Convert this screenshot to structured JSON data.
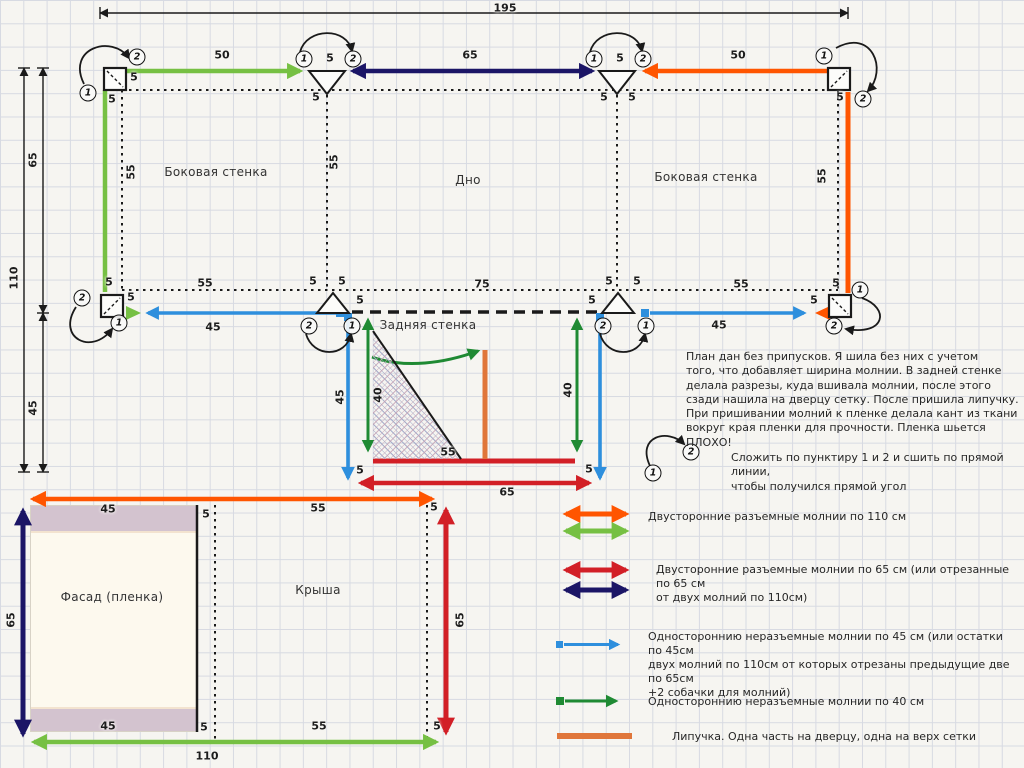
{
  "diagram_type": "sewing-pattern-plan",
  "colors": {
    "zipper_110_a": "#ff5500",
    "zipper_110_b": "#76c043",
    "zipper_65_a": "#d21f26",
    "zipper_65_b": "#1b1566",
    "zipper_45": "#2e8fdd",
    "zipper_40": "#1f8a33",
    "velcro": "#e0763a",
    "line": "#1a1a1a",
    "grid": "#d7dae2",
    "background": "#f6f5f1",
    "facade_band": "#d3c3cf",
    "facade_body": "#fdf9ee"
  },
  "panel_labels": [
    {
      "text": "Боковая стенка",
      "x": 216,
      "y": 172
    },
    {
      "text": "Дно",
      "x": 468,
      "y": 180
    },
    {
      "text": "Боковая стенка",
      "x": 706,
      "y": 177
    },
    {
      "text": "Задняя стенка",
      "x": 428,
      "y": 325
    },
    {
      "text": "Фасад (пленка)",
      "x": 112,
      "y": 597
    },
    {
      "text": "Крыша",
      "x": 318,
      "y": 590
    }
  ],
  "dim_labels": [
    {
      "t": "195",
      "x": 505,
      "y": 8
    },
    {
      "t": "50",
      "x": 222,
      "y": 55
    },
    {
      "t": "5",
      "x": 330,
      "y": 58
    },
    {
      "t": "65",
      "x": 470,
      "y": 55
    },
    {
      "t": "5",
      "x": 620,
      "y": 58
    },
    {
      "t": "50",
      "x": 738,
      "y": 55
    },
    {
      "t": "5",
      "x": 134,
      "y": 77
    },
    {
      "t": "5",
      "x": 112,
      "y": 99
    },
    {
      "t": "5",
      "x": 316,
      "y": 97
    },
    {
      "t": "5",
      "x": 604,
      "y": 97
    },
    {
      "t": "5",
      "x": 632,
      "y": 97
    },
    {
      "t": "5",
      "x": 840,
      "y": 97
    },
    {
      "t": "65",
      "x": 33,
      "y": 160,
      "r": 1
    },
    {
      "t": "110",
      "x": 14,
      "y": 278,
      "r": 1
    },
    {
      "t": "45",
      "x": 33,
      "y": 408,
      "r": 1
    },
    {
      "t": "55",
      "x": 131,
      "y": 172,
      "r": 1
    },
    {
      "t": "55",
      "x": 334,
      "y": 162,
      "r": 1
    },
    {
      "t": "55",
      "x": 822,
      "y": 176,
      "r": 1
    },
    {
      "t": "5",
      "x": 109,
      "y": 282
    },
    {
      "t": "55",
      "x": 205,
      "y": 283
    },
    {
      "t": "5",
      "x": 313,
      "y": 281
    },
    {
      "t": "5",
      "x": 342,
      "y": 281
    },
    {
      "t": "75",
      "x": 482,
      "y": 284
    },
    {
      "t": "5",
      "x": 609,
      "y": 281
    },
    {
      "t": "5",
      "x": 637,
      "y": 281
    },
    {
      "t": "55",
      "x": 741,
      "y": 284
    },
    {
      "t": "5",
      "x": 836,
      "y": 283
    },
    {
      "t": "5",
      "x": 131,
      "y": 297
    },
    {
      "t": "45",
      "x": 213,
      "y": 327
    },
    {
      "t": "5",
      "x": 360,
      "y": 300
    },
    {
      "t": "5",
      "x": 592,
      "y": 300
    },
    {
      "t": "45",
      "x": 719,
      "y": 325
    },
    {
      "t": "5",
      "x": 814,
      "y": 300
    },
    {
      "t": "45",
      "x": 340,
      "y": 397,
      "r": 1
    },
    {
      "t": "40",
      "x": 378,
      "y": 395,
      "r": 1
    },
    {
      "t": "40",
      "x": 568,
      "y": 390,
      "r": 1
    },
    {
      "t": "55",
      "x": 448,
      "y": 452
    },
    {
      "t": "5",
      "x": 360,
      "y": 470
    },
    {
      "t": "5",
      "x": 589,
      "y": 469
    },
    {
      "t": "65",
      "x": 507,
      "y": 492
    },
    {
      "t": "45",
      "x": 108,
      "y": 509
    },
    {
      "t": "5",
      "x": 206,
      "y": 514
    },
    {
      "t": "55",
      "x": 318,
      "y": 508
    },
    {
      "t": "5",
      "x": 434,
      "y": 507
    },
    {
      "t": "45",
      "x": 108,
      "y": 726
    },
    {
      "t": "5",
      "x": 204,
      "y": 727
    },
    {
      "t": "55",
      "x": 319,
      "y": 726
    },
    {
      "t": "5",
      "x": 437,
      "y": 726
    },
    {
      "t": "110",
      "x": 207,
      "y": 756
    },
    {
      "t": "65",
      "x": 11,
      "y": 620,
      "r": 1
    },
    {
      "t": "65",
      "x": 460,
      "y": 620,
      "r": 1
    }
  ],
  "circles": [
    {
      "n": "1",
      "x": 88,
      "y": 93
    },
    {
      "n": "2",
      "x": 137,
      "y": 57
    },
    {
      "n": "1",
      "x": 304,
      "y": 59
    },
    {
      "n": "2",
      "x": 353,
      "y": 59
    },
    {
      "n": "1",
      "x": 594,
      "y": 59
    },
    {
      "n": "2",
      "x": 643,
      "y": 59
    },
    {
      "n": "1",
      "x": 824,
      "y": 56
    },
    {
      "n": "2",
      "x": 863,
      "y": 99
    },
    {
      "n": "2",
      "x": 82,
      "y": 298
    },
    {
      "n": "1",
      "x": 119,
      "y": 323
    },
    {
      "n": "2",
      "x": 309,
      "y": 326
    },
    {
      "n": "1",
      "x": 352,
      "y": 326
    },
    {
      "n": "2",
      "x": 603,
      "y": 326
    },
    {
      "n": "1",
      "x": 646,
      "y": 326
    },
    {
      "n": "1",
      "x": 860,
      "y": 290
    },
    {
      "n": "2",
      "x": 834,
      "y": 326
    },
    {
      "n": "1",
      "x": 653,
      "y": 473
    },
    {
      "n": "2",
      "x": 691,
      "y": 452
    }
  ],
  "notes": {
    "main": "План дан без припусков. Я шила без них с учетом\nтого, что добавляет ширина молнии. В задней стенке\nделала разрезы, куда вшивала молнии, после этого\nсзади нашила на дверцу сетку. После пришила липучку.\nПри пришивании молний к пленке делала кант из ткани\nвокруг края пленки для прочности. Пленка шьется ПЛОХО!",
    "fold": "Сложить по пунктиру 1 и 2 и сшить по прямой линии,\nчтобы получился прямой угол"
  },
  "legend": {
    "items": [
      {
        "text": "Двусторонние разъемные молнии по 110 см"
      },
      {
        "text": "Двусторонние разъемные молнии по 65 см (или отрезанные по 65 см\nот двух молний по 110см)"
      },
      {
        "text": "Одностороннию неразъемные молнии по 45  см (или остатки по 45см\nдвух молний по 110см от которых отрезаны предыдущие две по 65см\n+2 собачки для молний)"
      },
      {
        "text": "Одностороннию неразъемные молнии по 40  см"
      },
      {
        "text": "Липучка. Одна часть на дверцу, одна на верх сетки"
      }
    ]
  }
}
